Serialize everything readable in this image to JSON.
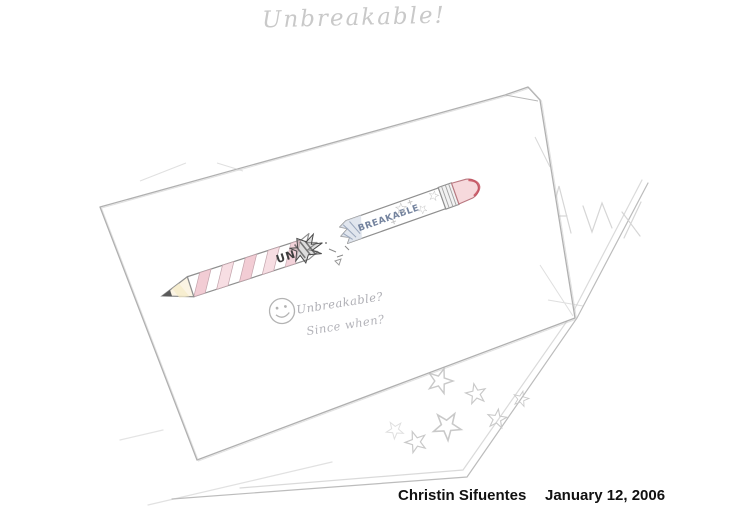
{
  "artwork": {
    "title": "Unbreakable!",
    "pencil": {
      "left_fragment_label": "UN",
      "right_fragment_label": "BREAKABLE"
    },
    "annotation": {
      "line1": "Unbreakable?",
      "line2": "Since when?"
    },
    "caption": {
      "name": "Christin Sifuentes",
      "date": "January 12, 2006"
    }
  },
  "colors": {
    "paper": "#ffffff",
    "sketch_line": "#b3b3b3",
    "pencil_outline": "#8f8f8f",
    "stripe_pink": "#f2ccd4",
    "stripe_pink_light": "#f7dee3",
    "wood_tint": "#f6ecc9",
    "graphite": "#5a5a5a",
    "eraser_pink": "#f6d9dc",
    "eraser_red": "#c4505e",
    "splinter_shadow": "#d9e0ea",
    "caption_ink": "#111111"
  }
}
